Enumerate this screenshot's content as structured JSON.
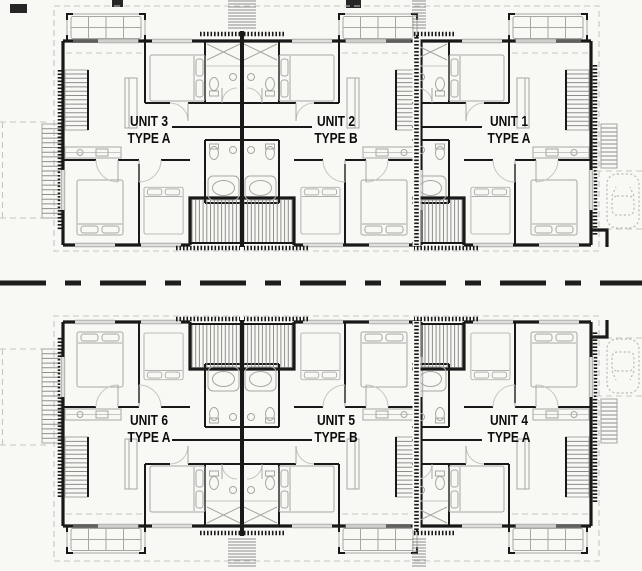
{
  "drawing": {
    "plans": {
      "upper": {
        "units": [
          {
            "unit_label": "UNIT 3",
            "type_label": "TYPE A"
          },
          {
            "unit_label": "UNIT 2",
            "type_label": "TYPE B"
          },
          {
            "unit_label": "UNIT 1",
            "type_label": "TYPE A"
          }
        ]
      },
      "lower": {
        "units": [
          {
            "unit_label": "UNIT 6",
            "type_label": "TYPE A"
          },
          {
            "unit_label": "UNIT 5",
            "type_label": "TYPE B"
          },
          {
            "unit_label": "UNIT 4",
            "type_label": "TYPE A"
          }
        ]
      }
    }
  },
  "colors": {
    "bg": "#f8f8f5",
    "wall": "#191919",
    "furn": "#a6a6a3",
    "hatch": "#8d8d8a",
    "light": "#c6c6c2",
    "road": "#1d1d1d",
    "label": "#0d0d0d"
  }
}
